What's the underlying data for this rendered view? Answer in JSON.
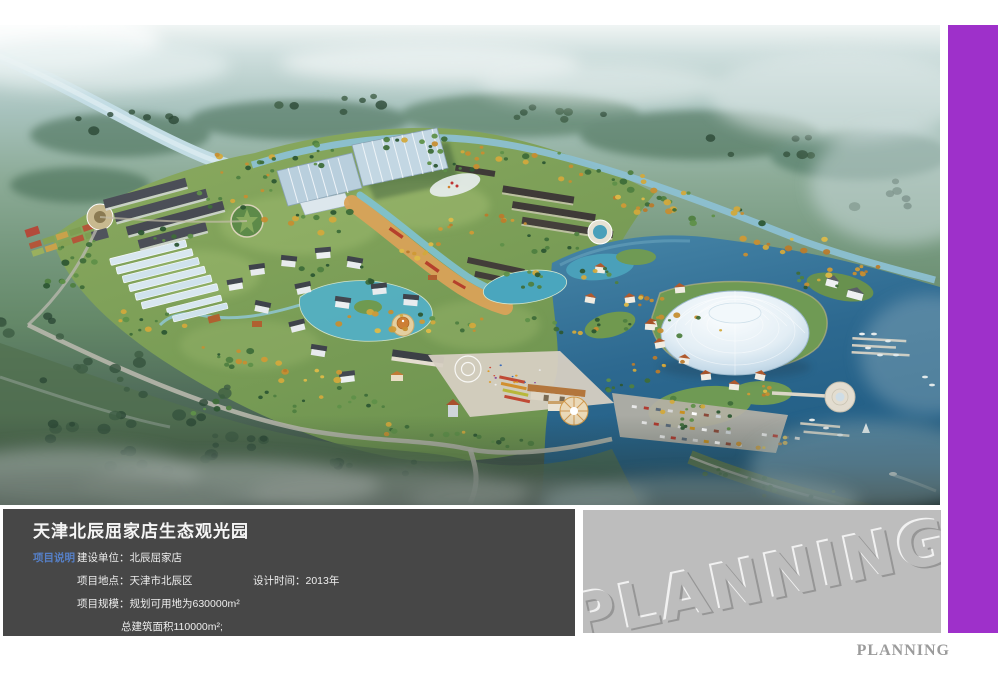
{
  "board": {
    "background": "#ffffff",
    "accent_color": "#9e30ca",
    "panel_color": "#474747",
    "gray_panel_color": "#bdbdbd"
  },
  "info_panel": {
    "title": "天津北辰屈家店生态观光园",
    "section_label": "项目说明",
    "builder": "建设单位：北辰屈家店",
    "location": "项目地点：天津市北辰区",
    "design_time": "设计时间：2013年",
    "scale": "项目规模：规划可用地为630000m²",
    "area": "总建筑面积110000m²;"
  },
  "watermark": {
    "text": "PLANNING"
  },
  "footer": {
    "text": "PLANNING"
  }
}
